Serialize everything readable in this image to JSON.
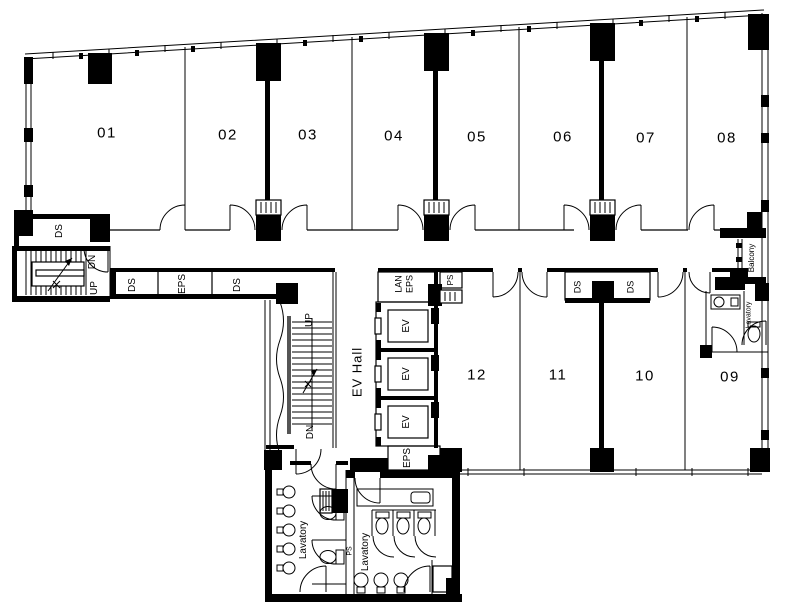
{
  "floor_plan": {
    "rooms_top": [
      {
        "id": "01"
      },
      {
        "id": "02"
      },
      {
        "id": "03"
      },
      {
        "id": "04"
      },
      {
        "id": "05"
      },
      {
        "id": "06"
      },
      {
        "id": "07"
      },
      {
        "id": "08"
      }
    ],
    "rooms_bottom": [
      {
        "id": "12"
      },
      {
        "id": "11"
      },
      {
        "id": "10"
      },
      {
        "id": "09"
      }
    ],
    "labels": {
      "up": "UP",
      "dn": "DN",
      "ds": "DS",
      "eps": "EPS",
      "lan": "LAN",
      "ps": "PS",
      "ev": "EV",
      "ev_hall": "EV Hall",
      "lavatory": "Lavatory",
      "balcony": "Balcony"
    },
    "colors": {
      "line": "#000000",
      "background": "#ffffff"
    }
  }
}
